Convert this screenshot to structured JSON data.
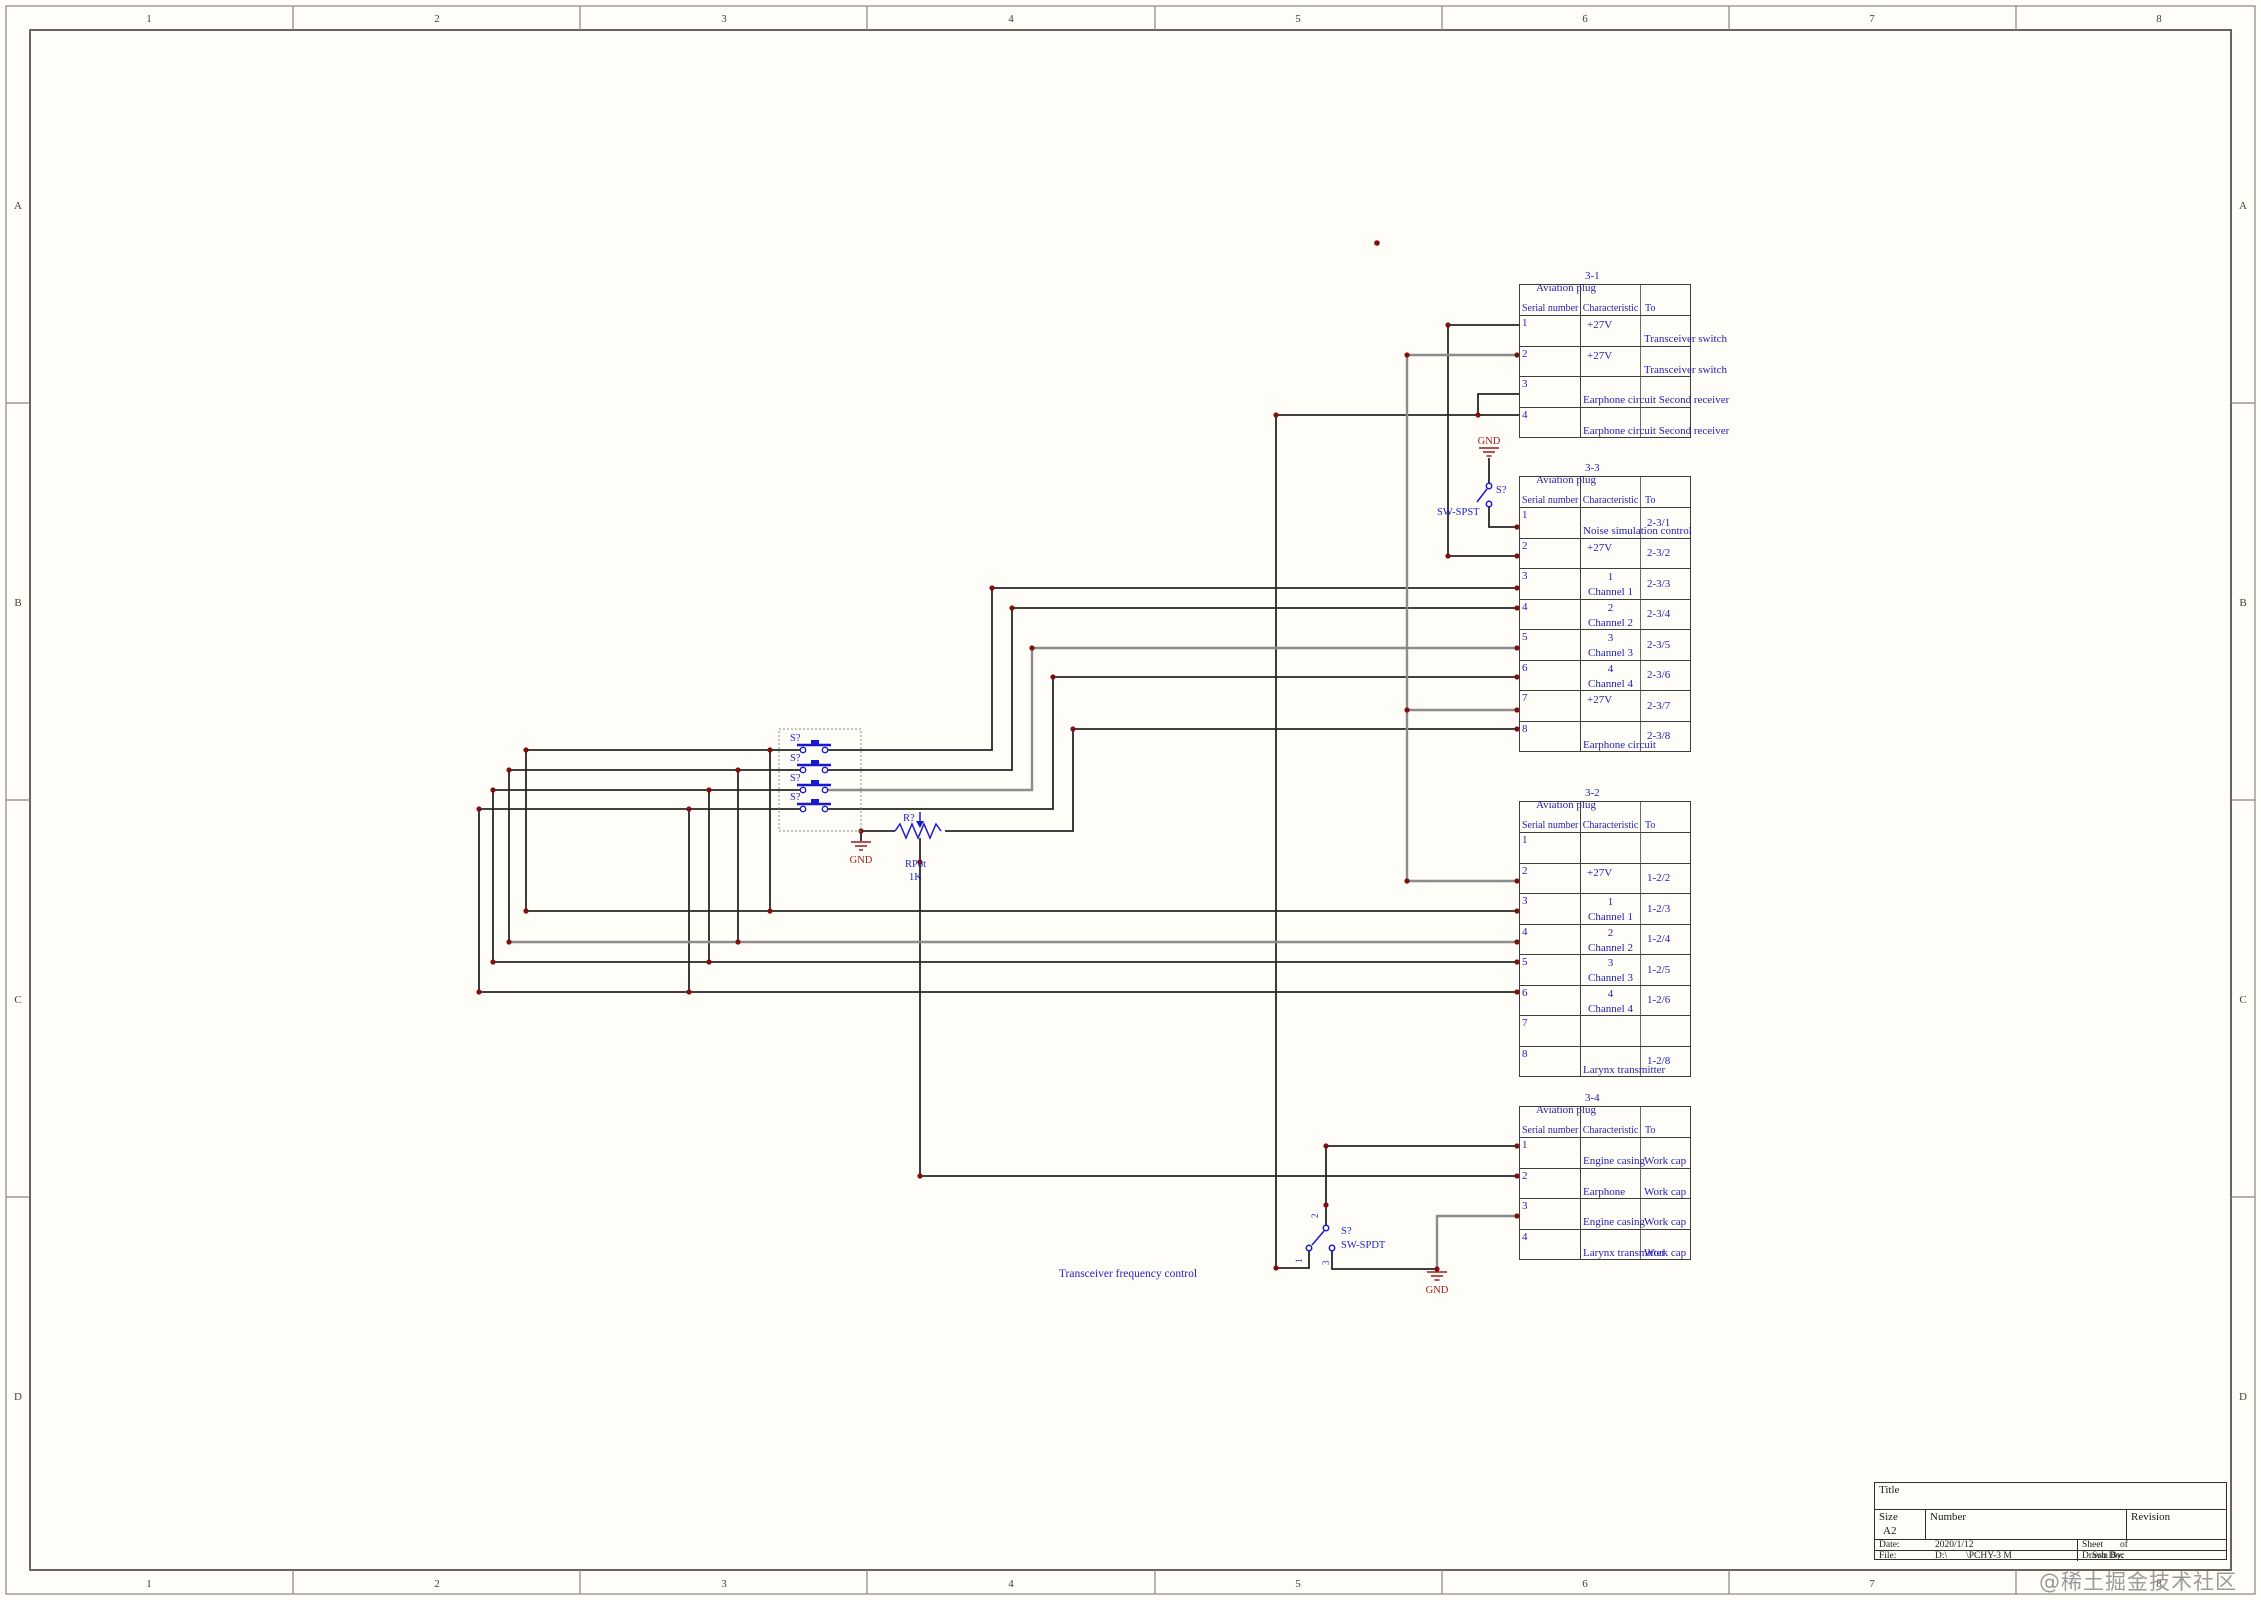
{
  "frame": {
    "columns": [
      "1",
      "2",
      "3",
      "4",
      "5",
      "6",
      "7",
      "8"
    ],
    "rows": [
      "A",
      "B",
      "C",
      "D"
    ]
  },
  "watermark": "@稀土掘金技术社区",
  "labels": {
    "pb1": "S?",
    "pb2": "S?",
    "pb3": "S?",
    "pb4": "S?",
    "gnd1": "GND",
    "gnd2": "GND",
    "gnd3": "GND",
    "r_ref": "R?",
    "r_type": "RPot",
    "r_val": "1K",
    "spst_ref": "S?",
    "spst_type": "SW-SPST",
    "spdt_ref": "S?",
    "spdt_type": "SW-SPDT",
    "spdt_pin1": "1",
    "spdt_pin2": "2",
    "spdt_pin3": "3",
    "freq_note": "Transceiver frequency control"
  },
  "title_block": {
    "title_label": "Title",
    "size_label": "Size",
    "size": "A2",
    "number_label": "Number",
    "revision_label": "Revision",
    "date_label": "Date:",
    "date": "2020/1/12",
    "sheet_label": "Sheet",
    "of_label": "of",
    "file_label": "File:",
    "file": "D:\\        \\PCHY-3 M",
    "drawn_label": "Drawn By:",
    "drawn_overlay": "Sch Doc"
  },
  "tables": [
    {
      "no": "3-1",
      "plug": "Aviation plug",
      "headers": [
        "Serial number",
        "Characteristic",
        "To"
      ],
      "rows": [
        {
          "sn": "1",
          "ch": "+27V",
          "ch2": "",
          "to": "",
          "to2": "Transceiver switch"
        },
        {
          "sn": "2",
          "ch": "+27V",
          "ch2": "",
          "to": "",
          "to2": "Transceiver switch"
        },
        {
          "sn": "3",
          "ch": "",
          "ch2": "Earphone circuit Second receiver",
          "to": "",
          "to2": ""
        },
        {
          "sn": "4",
          "ch": "",
          "ch2": "Earphone circuit Second receiver",
          "to": "",
          "to2": ""
        }
      ]
    },
    {
      "no": "3-3",
      "plug": "Aviation plug",
      "headers": [
        "Serial number",
        "Characteristic",
        "To"
      ],
      "rows": [
        {
          "sn": "1",
          "ch": "",
          "ch2": "Noise simulation control",
          "to": "2-3/1",
          "to2": ""
        },
        {
          "sn": "2",
          "ch": "+27V",
          "ch2": "",
          "to": "2-3/2",
          "to2": ""
        },
        {
          "sn": "3",
          "ch": "1",
          "ch2": "Channel 1",
          "to": "2-3/3",
          "to2": ""
        },
        {
          "sn": "4",
          "ch": "2",
          "ch2": "Channel 2",
          "to": "2-3/4",
          "to2": ""
        },
        {
          "sn": "5",
          "ch": "3",
          "ch2": "Channel 3",
          "to": "2-3/5",
          "to2": ""
        },
        {
          "sn": "6",
          "ch": "4",
          "ch2": "Channel 4",
          "to": "2-3/6",
          "to2": ""
        },
        {
          "sn": "7",
          "ch": "+27V",
          "ch2": "",
          "to": "2-3/7",
          "to2": ""
        },
        {
          "sn": "8",
          "ch": "",
          "ch2": "Earphone circuit",
          "to": "2-3/8",
          "to2": ""
        }
      ]
    },
    {
      "no": "3-2",
      "plug": "Aviation plug",
      "headers": [
        "Serial number",
        "Characteristic",
        "To"
      ],
      "rows": [
        {
          "sn": "1",
          "ch": "",
          "ch2": "",
          "to": "",
          "to2": ""
        },
        {
          "sn": "2",
          "ch": "+27V",
          "ch2": "",
          "to": "1-2/2",
          "to2": ""
        },
        {
          "sn": "3",
          "ch": "1",
          "ch2": "Channel 1",
          "to": "1-2/3",
          "to2": ""
        },
        {
          "sn": "4",
          "ch": "2",
          "ch2": "Channel 2",
          "to": "1-2/4",
          "to2": ""
        },
        {
          "sn": "5",
          "ch": "3",
          "ch2": "Channel 3",
          "to": "1-2/5",
          "to2": ""
        },
        {
          "sn": "6",
          "ch": "4",
          "ch2": "Channel 4",
          "to": "1-2/6",
          "to2": ""
        },
        {
          "sn": "7",
          "ch": "",
          "ch2": "",
          "to": "",
          "to2": ""
        },
        {
          "sn": "8",
          "ch": "",
          "ch2": "Larynx transmitter",
          "to": "1-2/8",
          "to2": ""
        }
      ]
    },
    {
      "no": "3-4",
      "plug": "Aviation plug",
      "headers": [
        "Serial number",
        "Characteristic",
        "To"
      ],
      "rows": [
        {
          "sn": "1",
          "ch": "",
          "ch2": "Engine casing",
          "to": "",
          "to2": "Work cap"
        },
        {
          "sn": "2",
          "ch": "",
          "ch2": "Earphone",
          "to": "",
          "to2": "Work cap"
        },
        {
          "sn": "3",
          "ch": "",
          "ch2": "Engine casing",
          "to": "",
          "to2": "Work cap"
        },
        {
          "sn": "4",
          "ch": "",
          "ch2": "Larynx transmitter",
          "to": "",
          "to2": "Work cap"
        }
      ]
    }
  ]
}
